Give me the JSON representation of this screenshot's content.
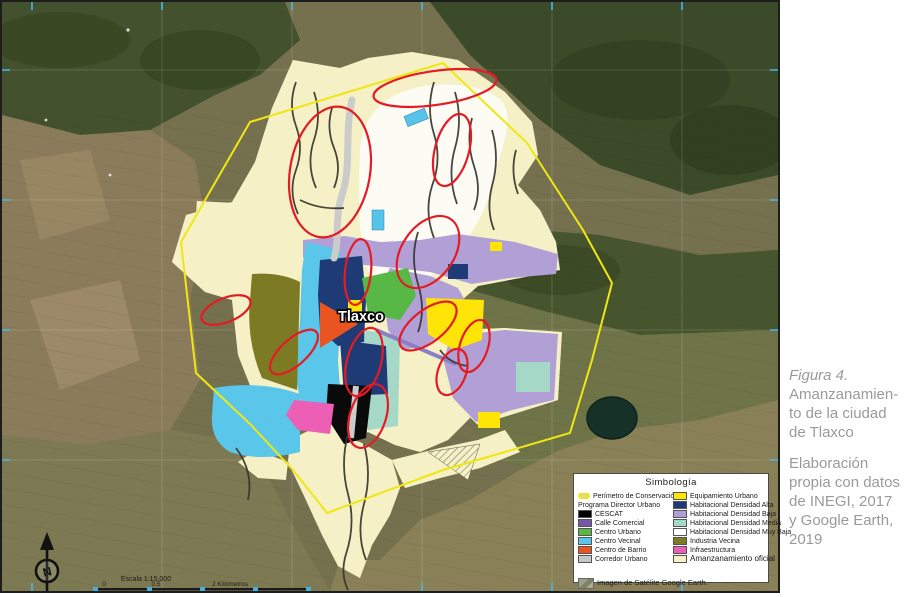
{
  "figure": {
    "caption_title": "Figura 4.",
    "caption_lines": [
      "Amanzanamien-",
      "to de la ciudad",
      "de Tlaxco"
    ],
    "source_lines": [
      "Elaboración",
      "propia con datos",
      "de INEGI, 2017",
      "y Google Earth,",
      "2019"
    ]
  },
  "map": {
    "city_label": "Tlaxco",
    "north_label": "N",
    "scale_text": "Escala 1:15,000",
    "scale_tick_0": "0",
    "scale_tick_05": "0.5",
    "scale_unit_label": "2 Kilómetros",
    "perimeter_color": "#efe712",
    "annotation_color": "#e51a24"
  },
  "legend": {
    "title": "Simbología",
    "perimeter": {
      "label": "Perímetro de Conservación",
      "color": "#efe712"
    },
    "program_heading": "Programa Director Urbano",
    "left_items": [
      {
        "label": "CESCAT",
        "color": "#000000"
      },
      {
        "label": "Calle Comercial",
        "color": "#7757a8"
      },
      {
        "label": "Centro Urbano",
        "color": "#58b845"
      },
      {
        "label": "Centro Vecinal",
        "color": "#5ac6ea"
      },
      {
        "label": "Centro de Barrio",
        "color": "#ea5420"
      },
      {
        "label": "Corredor Urbano",
        "color": "#c7c7c7"
      }
    ],
    "right_items": [
      {
        "label": "Equipamiento Urbano",
        "color": "#ffe408"
      },
      {
        "label": "Habitacional Densidad Alta",
        "color": "#1e3b76"
      },
      {
        "label": "Habitacional Densidad Baja",
        "color": "#b1a0d5"
      },
      {
        "label": "Habitacional Densidad Media",
        "color": "#a6d8c8"
      },
      {
        "label": "Habitacional Densidad Muy Baja",
        "color": "#ffffff"
      },
      {
        "label": "Industria Vecina",
        "color": "#7c7a23"
      },
      {
        "label": "Infraestructura",
        "color": "#ec5fb4"
      },
      {
        "label": "Amanzanamiento oficial",
        "color": "#f6f0c6"
      }
    ],
    "satellite_note": "Imagen de Satélite Google Earth."
  }
}
